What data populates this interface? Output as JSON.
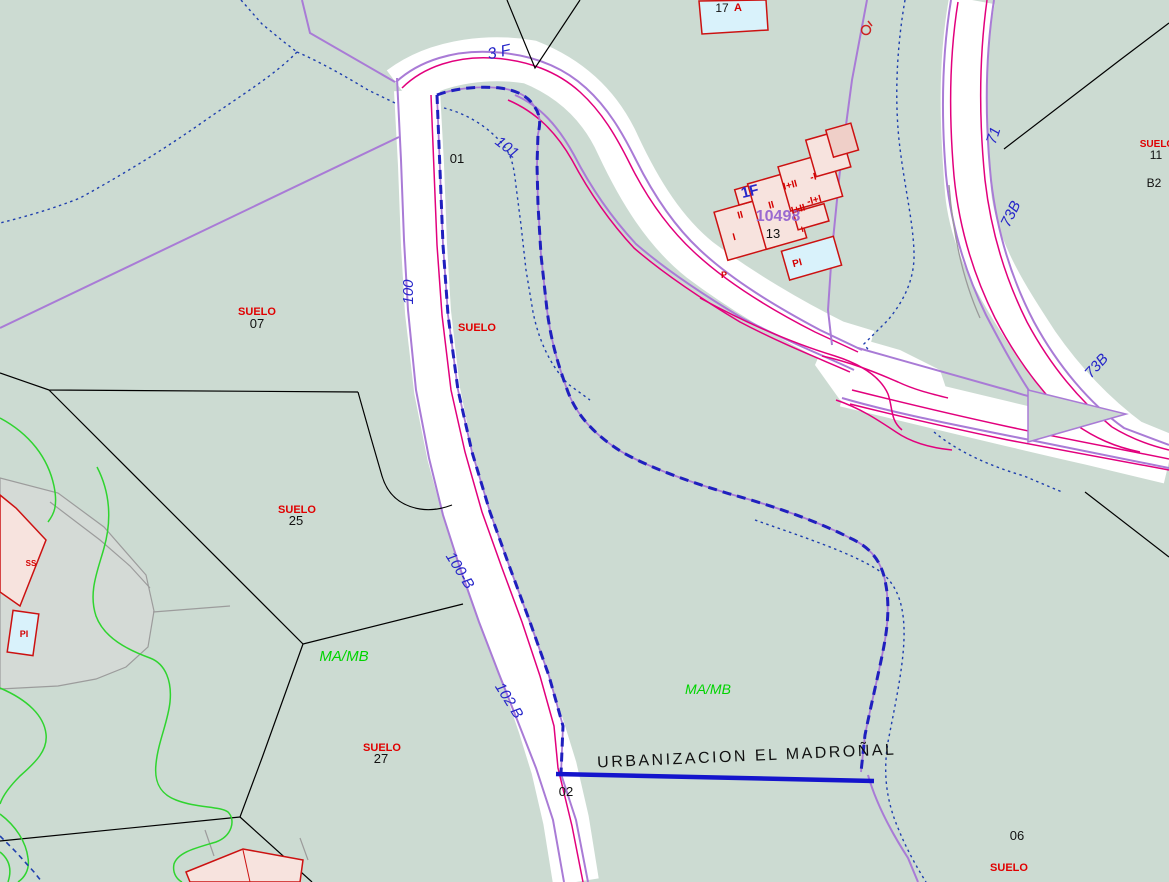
{
  "map": {
    "kind": "cadastral-map",
    "urbanization_name": "URBANIZACION EL MADROÑAL"
  },
  "colors": {
    "background": "#ccdbd2",
    "road_fill": "#ffffff",
    "road_casing": "#e2007d",
    "boundary_purple": "#a97bd6",
    "parcel_blue": "#1f1fbe",
    "stream_blue": "#1f3fae",
    "contour_green": "#2fd42f",
    "line_black": "#000000",
    "line_gray": "#9a9a9a",
    "patio_gray": "#d9d9d9",
    "building_fill": "#f7e3de",
    "building_fill_dark": "#efcfc8",
    "building_stroke": "#cc1111",
    "pool_fill": "#d9f2fb",
    "label_street": "#2626c9",
    "label_suelo": "#e00000",
    "label_zone": "#00d400",
    "label_ref": "#9a6ad0",
    "label_black": "#111111",
    "label_building": "#d40000"
  },
  "labels": [
    {
      "name": "street-label-3f",
      "text": "3 F",
      "x": 500,
      "y": 57,
      "size": 16,
      "cls": "street",
      "rot": -12
    },
    {
      "name": "street-label-101",
      "text": "101",
      "x": 504,
      "y": 151,
      "size": 15,
      "cls": "street",
      "rot": 38
    },
    {
      "name": "street-label-100",
      "text": "100",
      "x": 413,
      "y": 292,
      "size": 15,
      "cls": "street",
      "rot": -90
    },
    {
      "name": "street-label-100b",
      "text": "100-B",
      "x": 456,
      "y": 573,
      "size": 15,
      "cls": "street",
      "rot": 58
    },
    {
      "name": "street-label-102b",
      "text": "102 B",
      "x": 505,
      "y": 703,
      "size": 15,
      "cls": "street",
      "rot": 58
    },
    {
      "name": "street-label-71",
      "text": "71",
      "x": 998,
      "y": 137,
      "size": 15,
      "cls": "street",
      "rot": -72
    },
    {
      "name": "street-label-73b-upper",
      "text": "73B",
      "x": 1015,
      "y": 216,
      "size": 15,
      "cls": "street",
      "rot": -64
    },
    {
      "name": "street-label-73b-lower",
      "text": "73B",
      "x": 1100,
      "y": 369,
      "size": 15,
      "cls": "street",
      "rot": -48
    },
    {
      "name": "building-floor-label-1f",
      "text": "1F",
      "x": 751,
      "y": 196,
      "size": 15,
      "cls": "floor",
      "rot": -14
    },
    {
      "name": "building-ref-label-10498",
      "text": "10498",
      "x": 778,
      "y": 221,
      "size": 16,
      "cls": "ref",
      "rot": 0
    },
    {
      "name": "parcel-label-01",
      "text": "01",
      "x": 457,
      "y": 163,
      "size": 13,
      "cls": "num",
      "rot": 0
    },
    {
      "name": "parcel-label-07",
      "text": "07",
      "x": 257,
      "y": 328,
      "size": 13,
      "cls": "num",
      "rot": 0
    },
    {
      "name": "parcel-label-25",
      "text": "25",
      "x": 296,
      "y": 525,
      "size": 13,
      "cls": "num",
      "rot": 0
    },
    {
      "name": "parcel-label-27",
      "text": "27",
      "x": 381,
      "y": 763,
      "size": 13,
      "cls": "num",
      "rot": 0
    },
    {
      "name": "parcel-label-02",
      "text": "02",
      "x": 566,
      "y": 796,
      "size": 13,
      "cls": "num",
      "rot": 0
    },
    {
      "name": "parcel-label-13",
      "text": "13",
      "x": 773,
      "y": 238,
      "size": 13,
      "cls": "num",
      "rot": 0
    },
    {
      "name": "parcel-label-06",
      "text": "06",
      "x": 1017,
      "y": 840,
      "size": 13,
      "cls": "num",
      "rot": 0
    },
    {
      "name": "parcel-label-11",
      "text": "11",
      "x": 1156,
      "y": 159,
      "size": 12,
      "cls": "num",
      "rot": 0
    },
    {
      "name": "parcel-label-b2",
      "text": "B2",
      "x": 1154,
      "y": 187,
      "size": 12,
      "cls": "num",
      "rot": 0
    },
    {
      "name": "building-label-17",
      "text": "17",
      "x": 722,
      "y": 12,
      "size": 12,
      "cls": "num",
      "rot": 0
    },
    {
      "name": "building-label-a",
      "text": "A",
      "x": 738,
      "y": 11,
      "size": 11,
      "cls": "bld",
      "rot": 0
    },
    {
      "name": "suelo-label-roadside",
      "text": "SUELO",
      "x": 477,
      "y": 331,
      "size": 11,
      "cls": "suelo",
      "rot": 0
    },
    {
      "name": "suelo-label-07",
      "text": "SUELO",
      "x": 257,
      "y": 315,
      "size": 11,
      "cls": "suelo",
      "rot": 0
    },
    {
      "name": "suelo-label-25",
      "text": "SUELO",
      "x": 297,
      "y": 513,
      "size": 11,
      "cls": "suelo",
      "rot": 0
    },
    {
      "name": "suelo-label-27",
      "text": "SUELO",
      "x": 382,
      "y": 751,
      "size": 11,
      "cls": "suelo",
      "rot": 0
    },
    {
      "name": "suelo-label-06",
      "text": "SUELO",
      "x": 1009,
      "y": 871,
      "size": 11,
      "cls": "suelo",
      "rot": 0
    },
    {
      "name": "suelo-label-11",
      "text": "SUELO",
      "x": 1157,
      "y": 147,
      "size": 10,
      "cls": "suelo",
      "rot": 0
    },
    {
      "name": "zone-label-mamb-left",
      "text": "MA/MB",
      "x": 344,
      "y": 661,
      "size": 15,
      "cls": "zone",
      "rot": 0
    },
    {
      "name": "zone-label-mamb-right",
      "text": "MA/MB",
      "x": 708,
      "y": 694,
      "size": 14,
      "cls": "zone",
      "rot": 0
    },
    {
      "name": "urbanization-label",
      "text": "URBANIZACION EL MADROÑAL",
      "x": 747,
      "y": 761,
      "size": 16,
      "cls": "urb",
      "rot": -2.5
    },
    {
      "name": "building-height-label",
      "text": "II",
      "x": 741,
      "y": 218,
      "size": 10,
      "cls": "bld",
      "rot": -15
    },
    {
      "name": "building-height-label",
      "text": "II",
      "x": 772,
      "y": 208,
      "size": 10,
      "cls": "bld",
      "rot": -15
    },
    {
      "name": "building-height-label",
      "text": "I",
      "x": 735,
      "y": 240,
      "size": 10,
      "cls": "bld",
      "rot": -15
    },
    {
      "name": "building-height-label",
      "text": "I+II",
      "x": 791,
      "y": 188,
      "size": 10,
      "cls": "bld",
      "rot": -15
    },
    {
      "name": "building-height-label",
      "text": "-I",
      "x": 814,
      "y": 180,
      "size": 10,
      "cls": "bld",
      "rot": -15
    },
    {
      "name": "building-height-label",
      "text": "-I+I",
      "x": 815,
      "y": 203,
      "size": 10,
      "cls": "bld",
      "rot": -15
    },
    {
      "name": "building-height-label",
      "text": "I+II",
      "x": 799,
      "y": 212,
      "size": 10,
      "cls": "bld",
      "rot": -15
    },
    {
      "name": "building-height-label",
      "text": "I",
      "x": 803,
      "y": 232,
      "size": 8,
      "cls": "bld",
      "rot": -15
    },
    {
      "name": "pool-label-pi",
      "text": "PI",
      "x": 798,
      "y": 266,
      "size": 10,
      "cls": "bld",
      "rot": -15
    },
    {
      "name": "building-height-label",
      "text": "P",
      "x": 724,
      "y": 278,
      "size": 9,
      "cls": "bld",
      "rot": 0
    },
    {
      "name": "building-height-label",
      "text": "SS",
      "x": 31,
      "y": 566,
      "size": 8,
      "cls": "bld",
      "rot": 0
    },
    {
      "name": "pool-label-pi-left",
      "text": "PI",
      "x": 24,
      "y": 637,
      "size": 9,
      "cls": "bld",
      "rot": 0
    }
  ]
}
